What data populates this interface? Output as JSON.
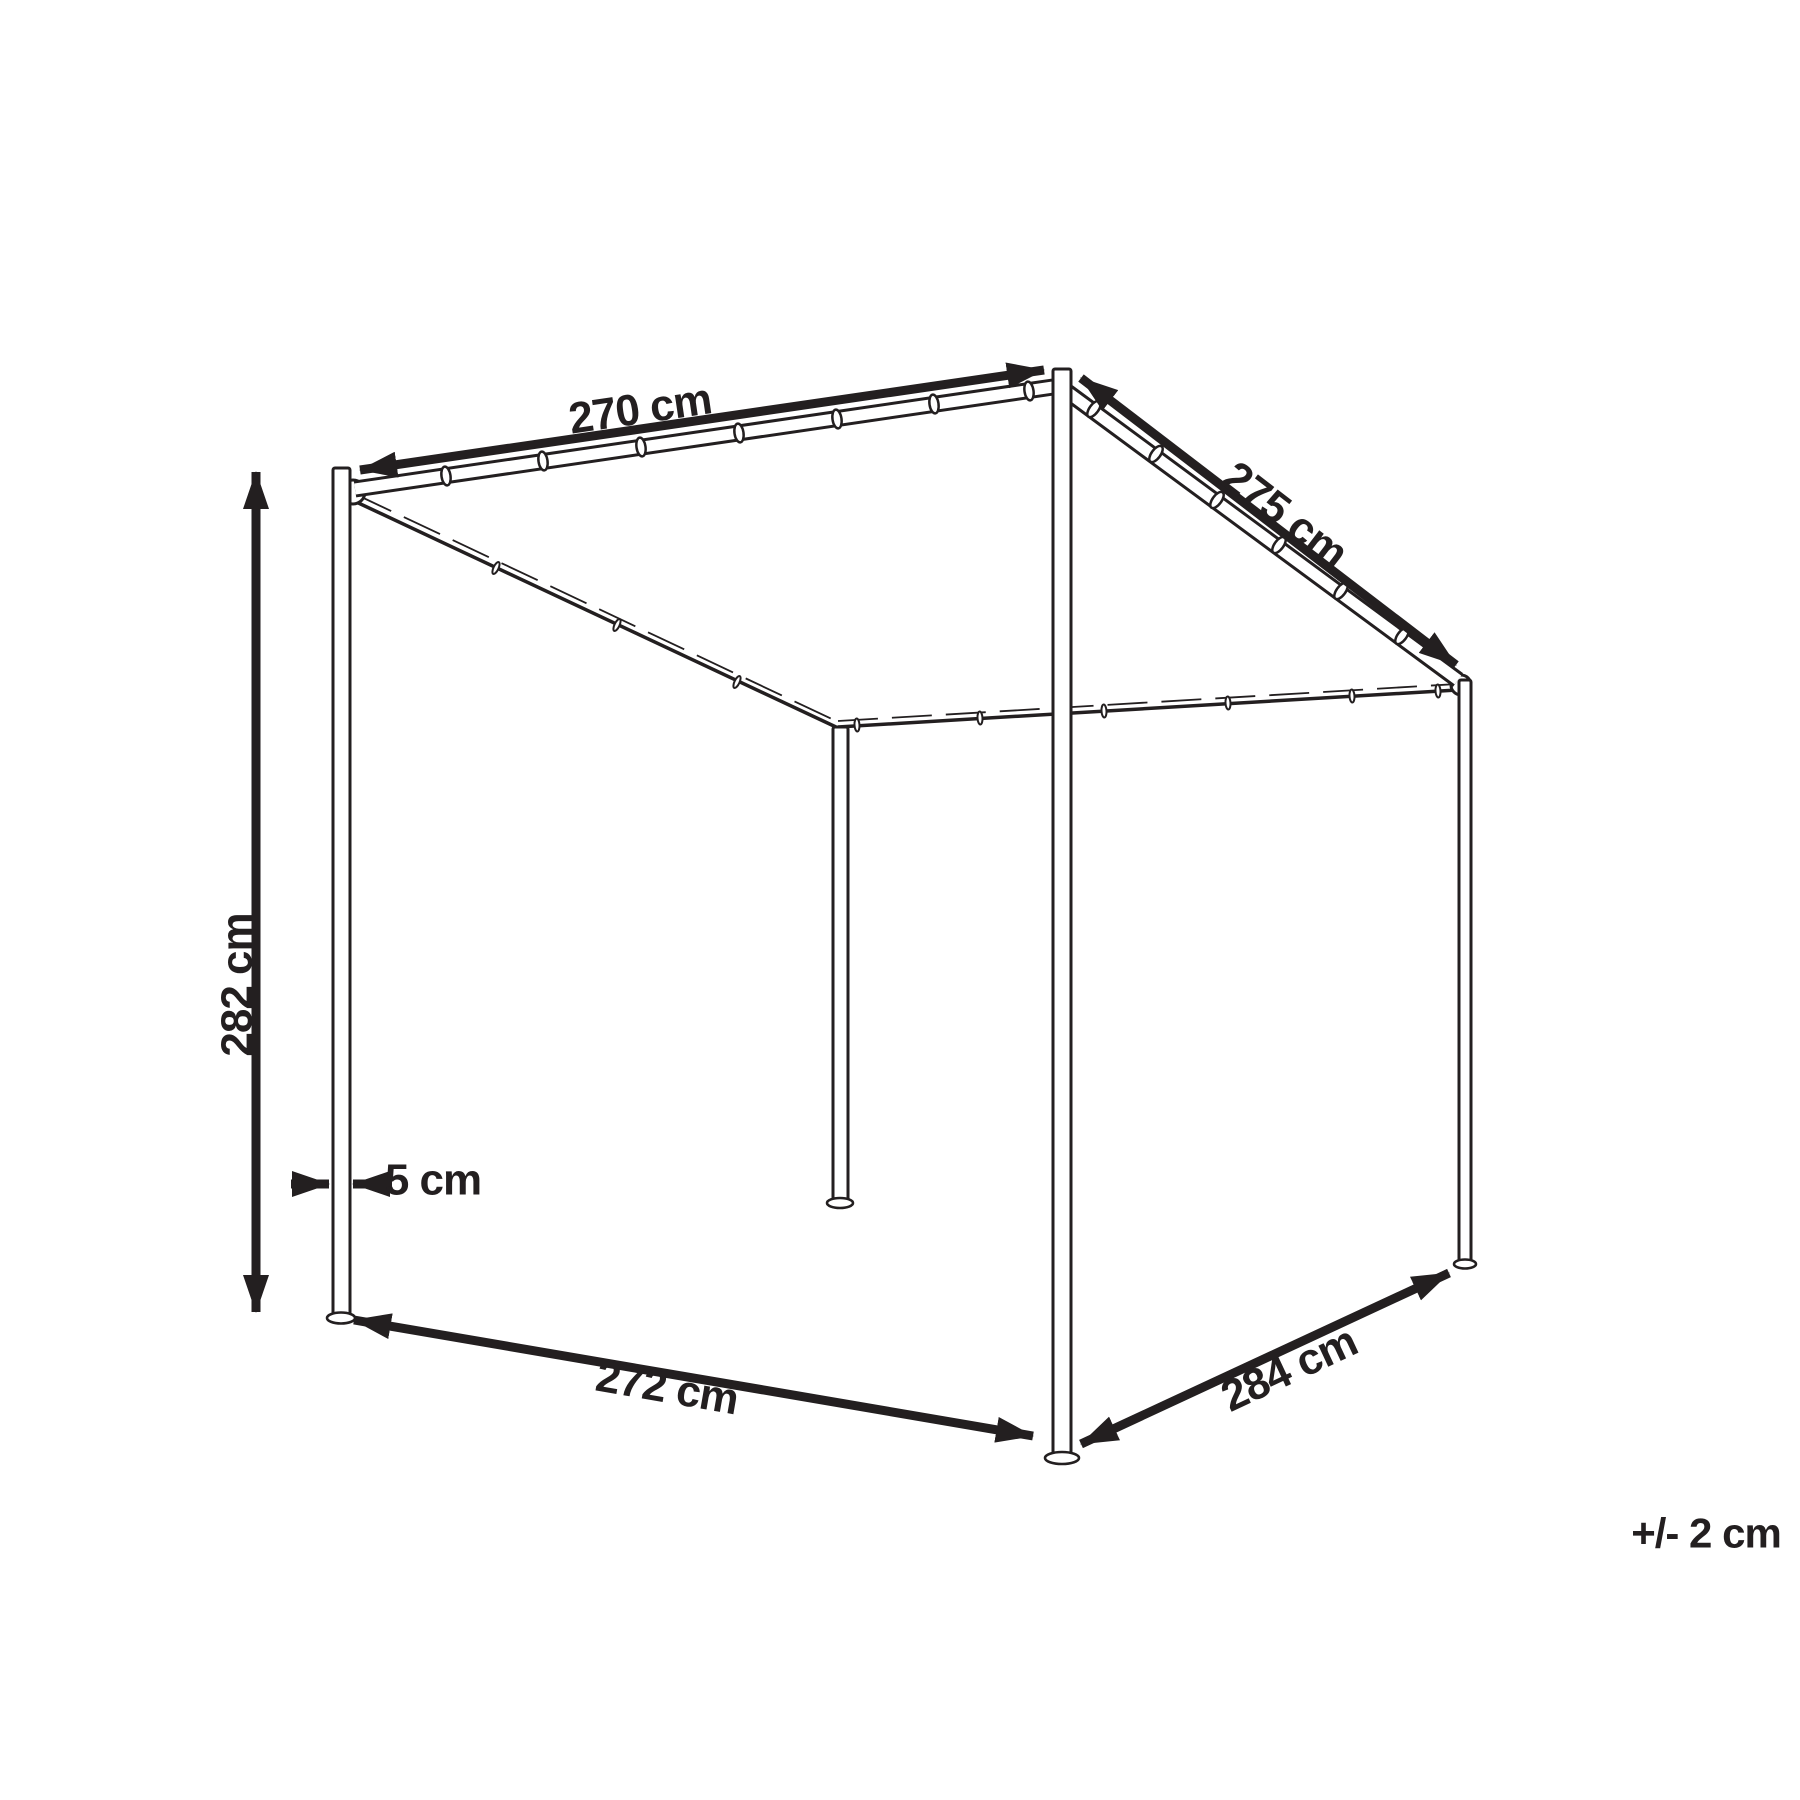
{
  "diagram": {
    "colors": {
      "line": "#231f20",
      "background": "#ffffff"
    },
    "dimensions": {
      "top_width": "270 cm",
      "roof_depth": "275 cm",
      "height": "282 cm",
      "post_thickness": "5 cm",
      "bottom_width": "272 cm",
      "bottom_depth": "284 cm",
      "tolerance": "+/- 2 cm"
    }
  }
}
